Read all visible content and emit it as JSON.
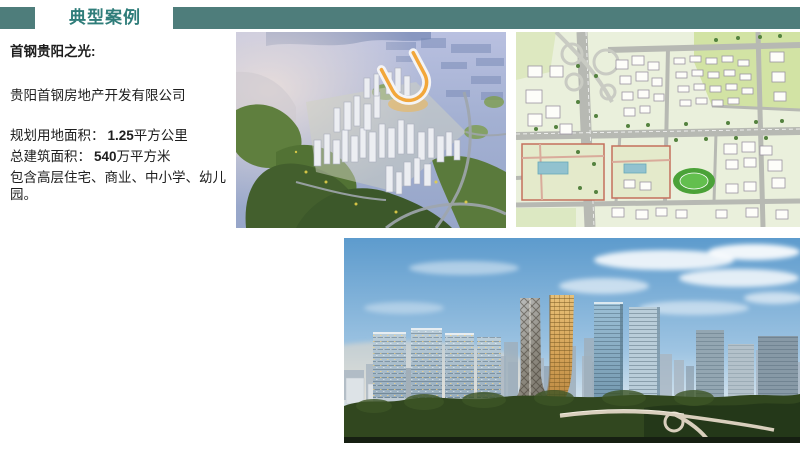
{
  "accent_color": "#4e7d7b",
  "title_color": "#2f7d7a",
  "header": {
    "title": "典型案例"
  },
  "info": {
    "project": "首钢贵阳之光:",
    "company": "贵阳首钢房地产开发有限公司",
    "land_area_label": "规划用地面积：",
    "land_area_value": "1.25",
    "land_area_unit": "平方公里",
    "building_area_label": "总建筑面积：",
    "building_area_value": "540",
    "building_area_unit": "万平方米",
    "composition": "包含高层住宅、商业、中小学、幼儿园。"
  }
}
